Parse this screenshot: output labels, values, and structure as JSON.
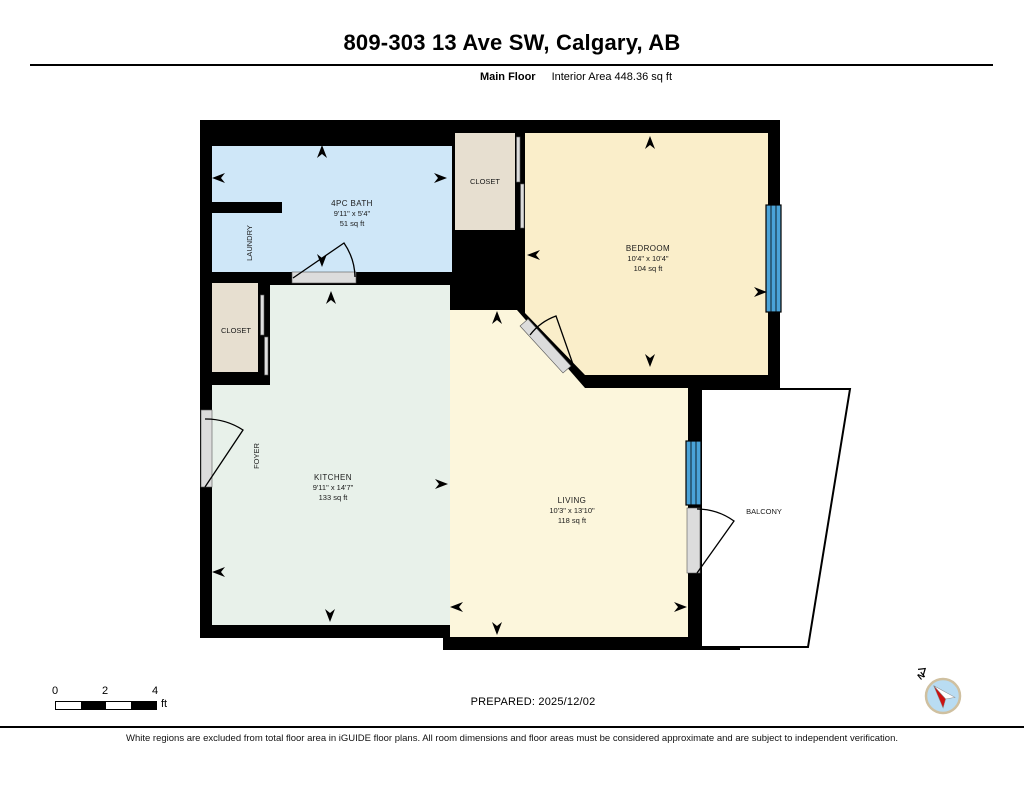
{
  "header": {
    "title": "809-303 13 Ave SW, Calgary, AB",
    "floor_label": "Main Floor",
    "area_label": "Interior Area 448.36 sq ft"
  },
  "rooms": {
    "bath": {
      "name": "4PC BATH",
      "dims": "9'11\" x 5'4\"",
      "area": "51 sq ft"
    },
    "bedroom": {
      "name": "BEDROOM",
      "dims": "10'4\" x 10'4\"",
      "area": "104 sq ft"
    },
    "kitchen": {
      "name": "KITCHEN",
      "dims": "9'11\" x 14'7\"",
      "area": "133 sq ft"
    },
    "living": {
      "name": "LIVING",
      "dims": "10'3\" x 13'10\"",
      "area": "118 sq ft"
    },
    "closet_top": {
      "name": "CLOSET"
    },
    "closet_left": {
      "name": "CLOSET"
    },
    "laundry": {
      "name": "LAUNDRY"
    },
    "foyer": {
      "name": "FOYER"
    },
    "balcony": {
      "name": "BALCONY"
    }
  },
  "scale_bar": {
    "ticks": [
      "0",
      "2",
      "4"
    ],
    "unit": "ft"
  },
  "footer": {
    "prepared_label": "PREPARED: 2025/12/02",
    "disclaimer": "White regions are excluded from total floor area in iGUIDE floor plans. All room dimensions and floor areas must be considered approximate and are subject to independent verification."
  },
  "compass": {
    "north_label": "N"
  },
  "colors": {
    "wall": "#000000",
    "bath": "#cfe7f8",
    "bedroom": "#faeeca",
    "kitchen": "#e8f1ea",
    "living": "#fcf6dc",
    "closet": "#e7dfd0",
    "window": "#4aa3d8",
    "door_sill": "#dcdcdc",
    "compass_fill": "#b9dcf2",
    "compass_ring": "#cfc0a0",
    "needle_red": "#cc1111"
  }
}
